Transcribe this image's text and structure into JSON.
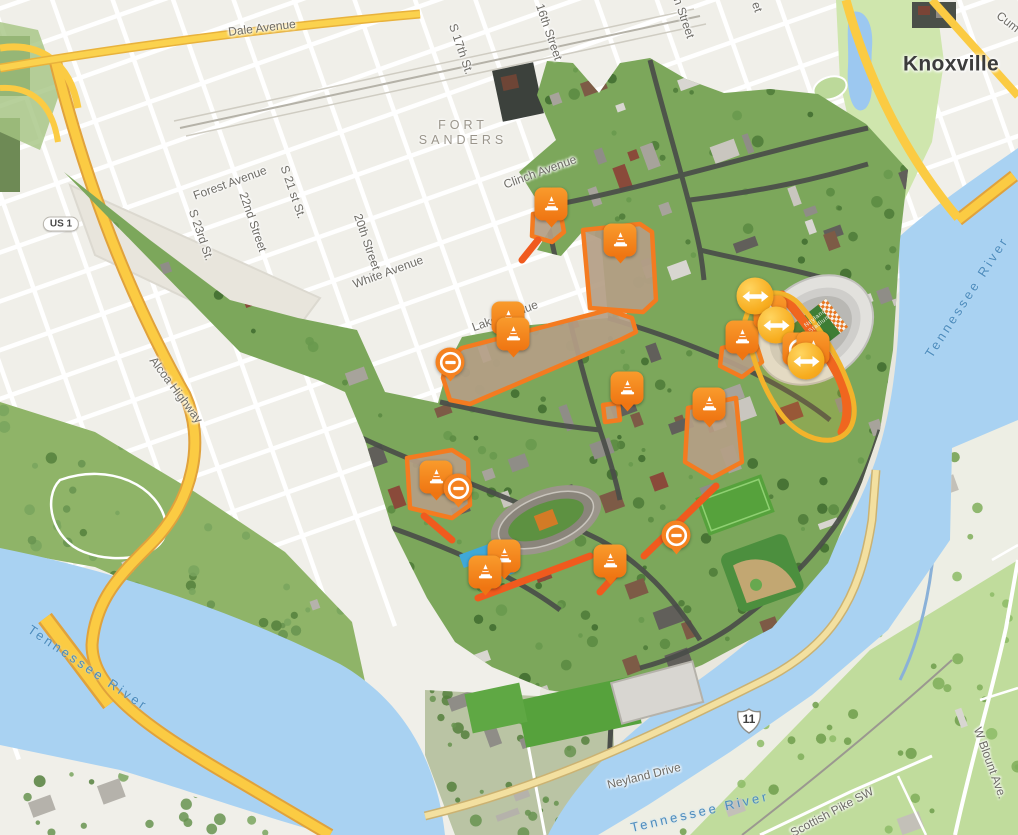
{
  "map": {
    "name": "University of Tennessee Knoxville campus map",
    "city_label": "Knoxville",
    "district_label": "FORT\nSANDERS"
  },
  "colors": {
    "marker_orange": "#F58220",
    "marker_gold": "#F6A81C",
    "zone_border": "#F47B20",
    "zone_fill": "#B49E85",
    "closed_road_orange": "#F05A1E",
    "highway_yellow": "#FBCB43",
    "water": "#A9D2F2"
  },
  "labels": [
    {
      "id": "dale-avenue",
      "text": "Dale Avenue",
      "x": 262,
      "y": 28,
      "rot": -7,
      "cls": "street"
    },
    {
      "id": "forest-avenue",
      "text": "Forest Avenue",
      "x": 230,
      "y": 183,
      "rot": -20,
      "cls": "street"
    },
    {
      "id": "white-avenue",
      "text": "White Avenue",
      "x": 388,
      "y": 272,
      "rot": -20,
      "cls": "street"
    },
    {
      "id": "clinch-avenue",
      "text": "Clinch Avenue",
      "x": 540,
      "y": 172,
      "rot": -20,
      "cls": "street"
    },
    {
      "id": "lake-avenue",
      "text": "Lake Avenue",
      "x": 505,
      "y": 316,
      "rot": -20,
      "cls": "street"
    },
    {
      "id": "sixteenth-street",
      "text": "16th Street",
      "x": 549,
      "y": 32,
      "rot": 71,
      "cls": "street"
    },
    {
      "id": "s-17th-st",
      "text": "S 17th St.",
      "x": 461,
      "y": 49,
      "rot": 71,
      "cls": "street"
    },
    {
      "id": "s-21st-st",
      "text": "S 21 st St.",
      "x": 293,
      "y": 192,
      "rot": 71,
      "cls": "street"
    },
    {
      "id": "twentysecond-street",
      "text": "22nd Street",
      "x": 253,
      "y": 222,
      "rot": 71,
      "cls": "street"
    },
    {
      "id": "twentieth-street",
      "text": "20th Street",
      "x": 367,
      "y": 242,
      "rot": 71,
      "cls": "street"
    },
    {
      "id": "s-23rd-st",
      "text": "S 23rd St.",
      "x": 201,
      "y": 235,
      "rot": 71,
      "cls": "street"
    },
    {
      "id": "fort-sanders",
      "text": "FORT\nSANDERS",
      "x": 463,
      "y": 133,
      "rot": 0,
      "cls": "area"
    },
    {
      "id": "knoxville",
      "text": "Knoxville",
      "x": 951,
      "y": 64,
      "rot": 0,
      "cls": "city"
    },
    {
      "id": "cumberland-partial",
      "text": "Cum",
      "x": 1008,
      "y": 22,
      "rot": 38,
      "cls": "street"
    },
    {
      "id": "street-partial",
      "text": "n Street",
      "x": 684,
      "y": 18,
      "rot": 71,
      "cls": "street"
    },
    {
      "id": "street-partial-2",
      "text": "et",
      "x": 757,
      "y": 7,
      "rot": 71,
      "cls": "street"
    },
    {
      "id": "alcoa-highway",
      "text": "Alcoa Highway",
      "x": 176,
      "y": 390,
      "rot": 53,
      "cls": "street"
    },
    {
      "id": "neyland-drive",
      "text": "Neyland Drive",
      "x": 644,
      "y": 776,
      "rot": -14,
      "cls": "street"
    },
    {
      "id": "w-blount-ave",
      "text": "W Blount Ave.",
      "x": 990,
      "y": 763,
      "rot": 70,
      "cls": "street"
    },
    {
      "id": "scottish-pike-sw",
      "text": "Scottish Pike SW",
      "x": 832,
      "y": 812,
      "rot": -28,
      "cls": "street"
    },
    {
      "id": "tennessee-river-west",
      "text": "Tennessee River",
      "x": 88,
      "y": 668,
      "rot": 34,
      "cls": "water"
    },
    {
      "id": "tennessee-river-east",
      "text": "Tennessee River",
      "x": 967,
      "y": 297,
      "rot": -57,
      "cls": "water"
    },
    {
      "id": "tennessee-river-south",
      "text": "Tennessee River",
      "x": 700,
      "y": 812,
      "rot": -13,
      "cls": "water"
    },
    {
      "id": "neyland-stadium",
      "text": "Neyland\nStadium",
      "x": 818,
      "y": 322,
      "rot": -38,
      "cls": "venue"
    }
  ],
  "shields": [
    {
      "id": "us-highway-shield",
      "kind": "us-pill",
      "text": "US 1",
      "x": 61,
      "y": 224
    },
    {
      "id": "route-11-shield",
      "kind": "us-shield",
      "text": "11",
      "x": 749,
      "y": 721
    }
  ],
  "markers": [
    {
      "type": "cone",
      "x": 551,
      "y": 204
    },
    {
      "type": "cone",
      "x": 620,
      "y": 240
    },
    {
      "type": "cone",
      "x": 508,
      "y": 318
    },
    {
      "type": "cone",
      "x": 513,
      "y": 334
    },
    {
      "type": "no-entry",
      "x": 450,
      "y": 362
    },
    {
      "type": "cone",
      "x": 627,
      "y": 388
    },
    {
      "type": "cone",
      "x": 742,
      "y": 337
    },
    {
      "type": "cone",
      "x": 709,
      "y": 404
    },
    {
      "type": "cone",
      "x": 436,
      "y": 477
    },
    {
      "type": "no-entry",
      "x": 458,
      "y": 488
    },
    {
      "type": "cone",
      "x": 504,
      "y": 556
    },
    {
      "type": "cone",
      "x": 485,
      "y": 572
    },
    {
      "type": "cone",
      "x": 610,
      "y": 561
    },
    {
      "type": "no-entry",
      "x": 676,
      "y": 535
    },
    {
      "type": "cone",
      "x": 770,
      "y": 312
    },
    {
      "type": "detour-arrows",
      "x": 755,
      "y": 296
    },
    {
      "type": "detour-arrows",
      "x": 776,
      "y": 325
    },
    {
      "type": "no-entry-square",
      "x": 799,
      "y": 349
    },
    {
      "type": "cone",
      "x": 813,
      "y": 348
    },
    {
      "type": "detour-arrows",
      "x": 806,
      "y": 361
    }
  ]
}
